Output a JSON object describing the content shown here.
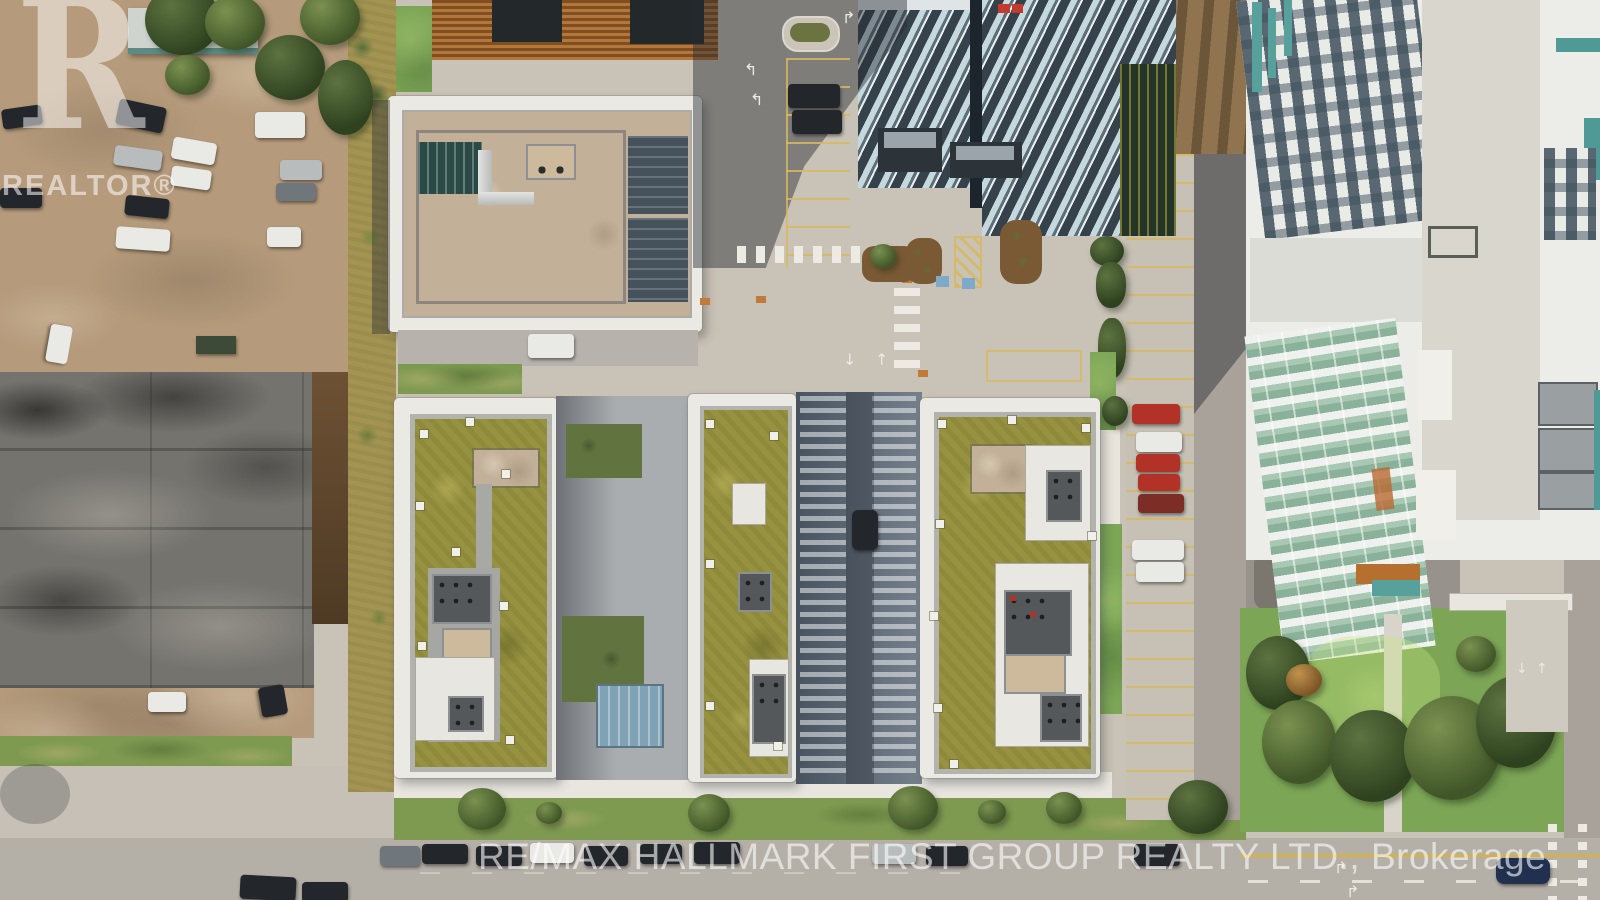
{
  "meta": {
    "type": "aerial-drone-photograph",
    "subject": "Top-down drone view of a condominium development: three green-roofed mid-rise buildings in the centre, a beige-roofed mid-rise above them, glass residential towers top right, a large white building with a green-glass atrium and rooftop trees on the right, an industrial flat roof and dirt parking lot on the left, streets with crosswalks, parking areas with cars, and a tree-filled park bottom right",
    "width_px": 1600,
    "height_px": 900
  },
  "watermarks": {
    "logo_letter": "R",
    "logo_caption": "REALTOR®",
    "brokerage": "RE/MAX HALLMARK FIRST GROUP REALTY LTD., Brokerage"
  },
  "road_markings": {
    "left_turn_arrow": "↰",
    "right_turn_arrow": "↱",
    "up_arrow": "↑",
    "down_arrow": "↓"
  },
  "palette": {
    "dirt": "#b59a7b",
    "dirt_dark": "#8f744f",
    "industrial_roof": "#75736e",
    "scrub_belt": "#a39452",
    "concrete": "#c9c2b6",
    "sidewalk_white": "#e9e6df",
    "asphalt": "#a8a29a",
    "asphalt_shadow": "#53555a",
    "building_white": "#ebe9e3",
    "gravel_roof": "#c3b098",
    "green_roof": "#97923f",
    "mech_gray": "#54585a",
    "glass_dark": "#45525c",
    "alley_shade": "#5d6774",
    "tower_glass": "#c5d8de",
    "tower_frame": "#35424b",
    "atrium_glass_green": "#a9c8b3",
    "lawn_green": "#7ca556",
    "road_yellow": "#d3b14e",
    "marking_white": "#eceae2",
    "car_black": "#23272c",
    "car_white": "#e9e9e5",
    "car_red": "#b23227",
    "car_navy": "#20304e",
    "accent_orange": "#c27a3b",
    "accent_teal": "#4f9a96",
    "watermark_white": "rgba(255,255,255,0.55)"
  }
}
